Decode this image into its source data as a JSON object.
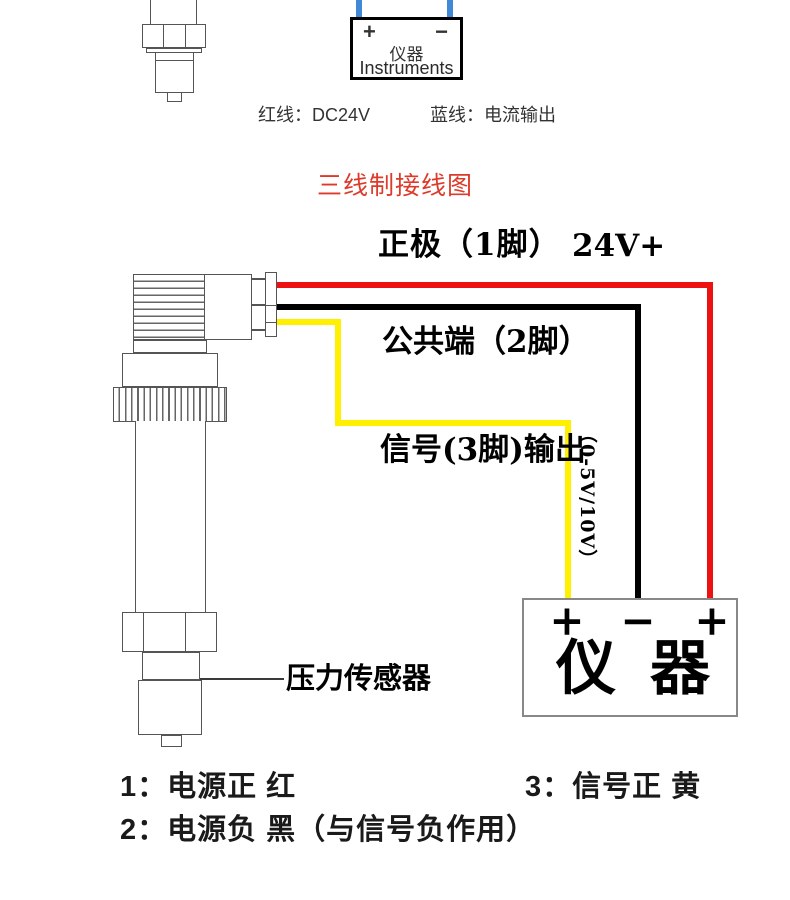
{
  "colors": {
    "red": "#ee1111",
    "black": "#000000",
    "yellow": "#ffef00",
    "blue": "#4189d6",
    "title": "#dd3a2a"
  },
  "top": {
    "instrument_box": {
      "plus": "+",
      "minus": "−",
      "name_cn": "仪器",
      "name_en": "Instruments"
    },
    "caption_red": "红线：DC24V",
    "caption_blue": "蓝线：电流输出"
  },
  "title": "三线制接线图",
  "diagram": {
    "label_positive": "正极（1脚）",
    "label_positive_v": "24V+",
    "label_common": "公共端（2脚）",
    "label_signal": "信号(3脚)输出",
    "label_signal_range": "（0-5V/10V）",
    "label_sensor": "压力传感器",
    "instrument_box": {
      "plus_left": "+",
      "minus": "−",
      "plus_right": "+",
      "name": "仪器"
    }
  },
  "notes": {
    "n1": "1：电源正 红",
    "n3": "3：信号正 黄",
    "n2": "2：电源负 黑（与信号负作用）"
  }
}
